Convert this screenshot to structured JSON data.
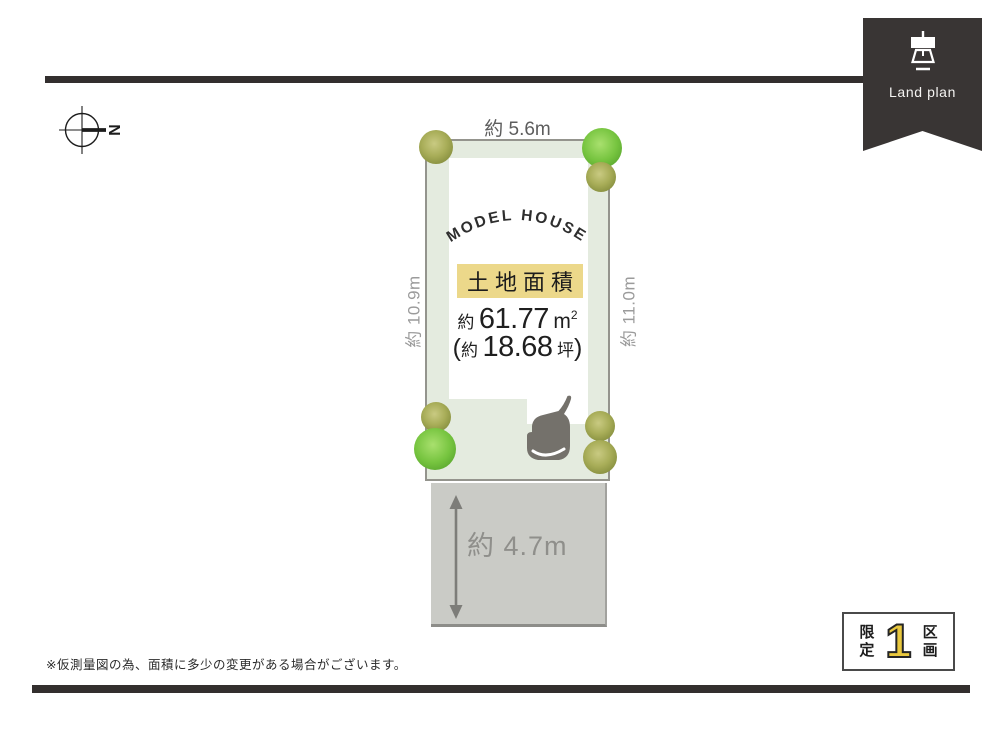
{
  "ribbon": {
    "label": "Land plan",
    "icon": "survey-instrument-icon",
    "color": "#393534"
  },
  "compass": {
    "letter": "N"
  },
  "plot": {
    "model_house": "MODEL HOUSE",
    "area_label": "土地面積",
    "area_sqm_prefix": "約",
    "area_sqm_value": "61.77",
    "area_sqm_unit_base": "m",
    "area_sqm_unit_sup": "2",
    "area_tsubo_open": "(",
    "area_tsubo_prefix": "約",
    "area_tsubo_value": "18.68",
    "area_tsubo_unit": "坪",
    "area_tsubo_close": ")",
    "dim_top": "約 5.6m",
    "dim_left": "約 10.9m",
    "dim_right": "約 11.0m",
    "dim_front": "約 4.7m"
  },
  "badge": {
    "prefix": "限定",
    "number": "1",
    "suffix": "区画"
  },
  "footnote": "※仮測量図の為、面積に多少の変更がある場合がございます。",
  "colors": {
    "accent_yellow": "#ecd88a",
    "plot_green": "#e4ebdf",
    "road_gray": "#cacbc6",
    "bar_dark": "#332f2e",
    "badge_number_yellow": "#e9c83e",
    "tree_olive": "#a8ad58",
    "tree_green": "#76c43f",
    "car_gray": "#74716b"
  }
}
